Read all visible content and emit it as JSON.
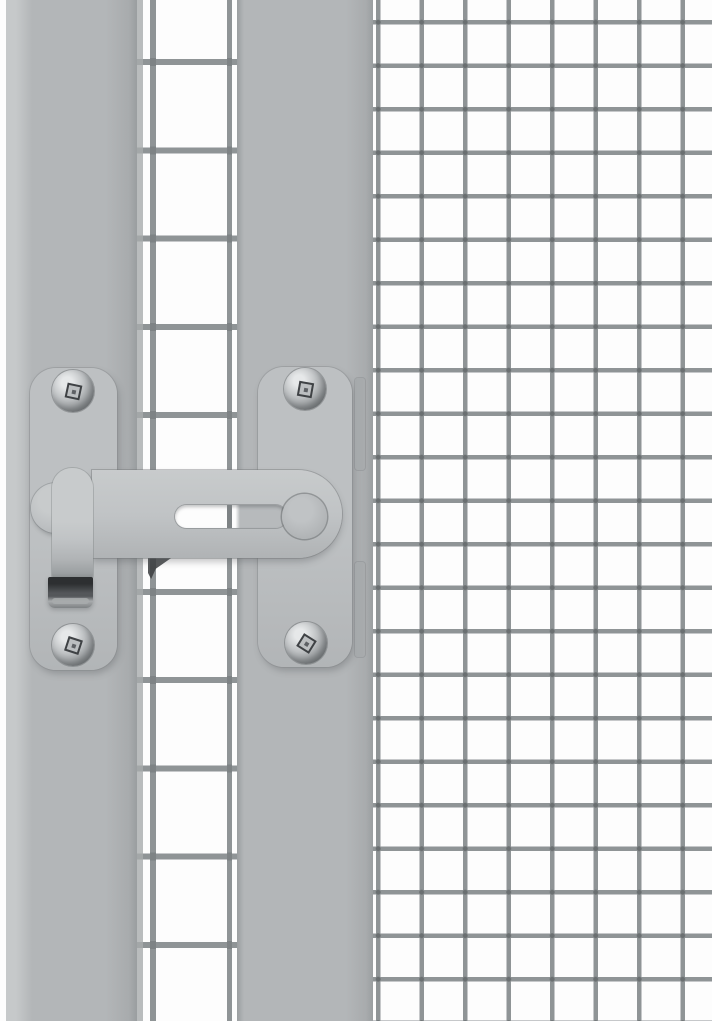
{
  "scene": {
    "type": "product-photo",
    "subject": "Grey steel gate latch lock mounted between a solid gate frame post and wire mesh panels",
    "background": "white",
    "components": {
      "left_white_margin": "narrow white strip at image left edge",
      "gate_frame_post_left": "wide flat grey vertical post",
      "gate_mesh_column": "tall mesh column with large rectangular cells between the two posts",
      "cage_frame_post": "flat grey vertical post of the cage frame",
      "cage_mesh_panel": "fine square welded wire mesh filling the right side",
      "latch_assembly": "swivel gate latch with two screwed mounting plates, slotted latch bar, pivot disc, round knob, folded dark handle and keeper strips"
    },
    "screw_count": 4,
    "text_content": "none"
  },
  "css_vars": {
    "c-white": "#fdfdfd",
    "c-margin-line": "#d2d5d6",
    "c-post": "#b3b6b8",
    "c-post-hi": "#c6c9ca",
    "c-post-lo": "#a8abad",
    "c-post-edge": "#9a9ea0",
    "c-plate": "#bdc0c2",
    "c-plate-lo": "#b2b5b7",
    "c-bar-hi": "#c8cbcc",
    "c-bar": "#c0c3c5",
    "c-bar-lo": "#b0b3b5",
    "c-arm-mid": "#9da1a3",
    "c-arm-lo": "#898d8f",
    "c-wire": "#8f9496",
    "c-wire-dark": "#7e8385",
    "c-weld": "rgba(70,74,76,0.5)",
    "c-slot-gray": "#b7babc",
    "c-keeper": "#a5a9ab",
    "c-screw-hi": "#e6e8e9",
    "c-screw-mid": "#bcbfc1",
    "c-screw-lo": "#7e8284",
    "c-screw-edge": "#636769",
    "c-drive": "#3f4245",
    "c-handle-dark": "#2d2f31",
    "c-handle-mid": "#54575a",
    "c-handle-hi": "#a8abad",
    "c-hook": "#3a3c3e",
    "c-shadow": "rgba(80,84,86,0.32)"
  }
}
